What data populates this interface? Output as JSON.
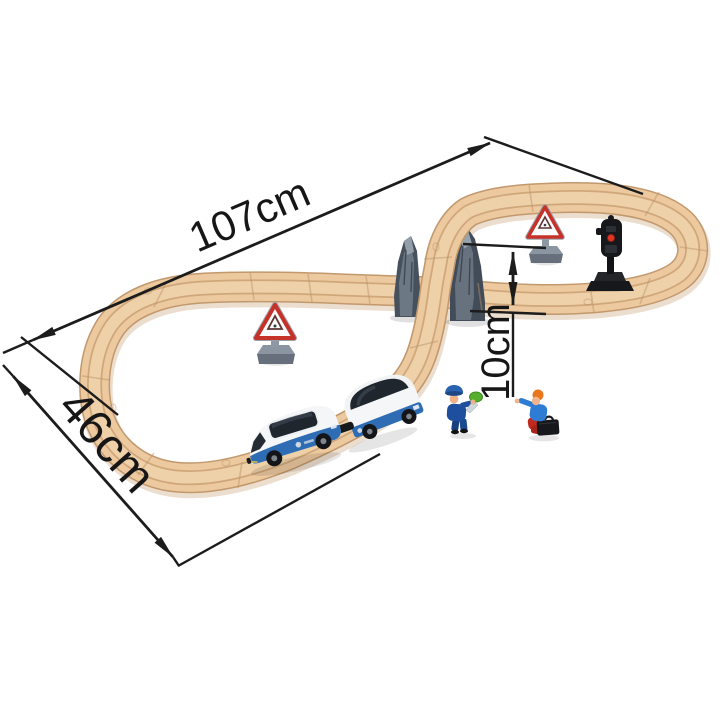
{
  "meta": {
    "description": "Product photo of a figure-eight wooden railway train set shown with overall dimension arrows",
    "background": "#ffffff"
  },
  "labels": {
    "track_length": "107cm",
    "track_width": "46cm",
    "bridge_height": "10cm"
  },
  "palette": {
    "wood": "#ecc99f",
    "wood_edge": "#c2986d",
    "wood_groove": "#d0a77b",
    "rock_gray": "#5a6572",
    "train_blue": "#2e6cb4",
    "train_white": "#f4f6f7",
    "window_tint": "#20262e",
    "sign_red": "#c53229",
    "sign_base_gray": "#8b95a1",
    "signal_black": "#17181c",
    "signal_red": "#e23420",
    "conductor_navy": "#1d4f9e",
    "passenger_blue": "#2e7cd4",
    "passenger_red": "#c02a1e",
    "paddle_green": "#54b02c",
    "dimension_line_color": "#1c1c1c"
  },
  "objects": {
    "track": "figure-eight wooden track",
    "bridge": "gray rock piers carrying the ramp over the straight track",
    "train": {
      "engine": "blue and white battery engine",
      "wagon": "blue and white passenger coach"
    },
    "signs": [
      "triangular warning sign inside upper loop",
      "triangular warning sign inside lower loop"
    ],
    "signal": "black railway signal light with red lamp",
    "figures": [
      "conductor holding green signal paddle",
      "passenger with briefcase waving"
    ]
  }
}
